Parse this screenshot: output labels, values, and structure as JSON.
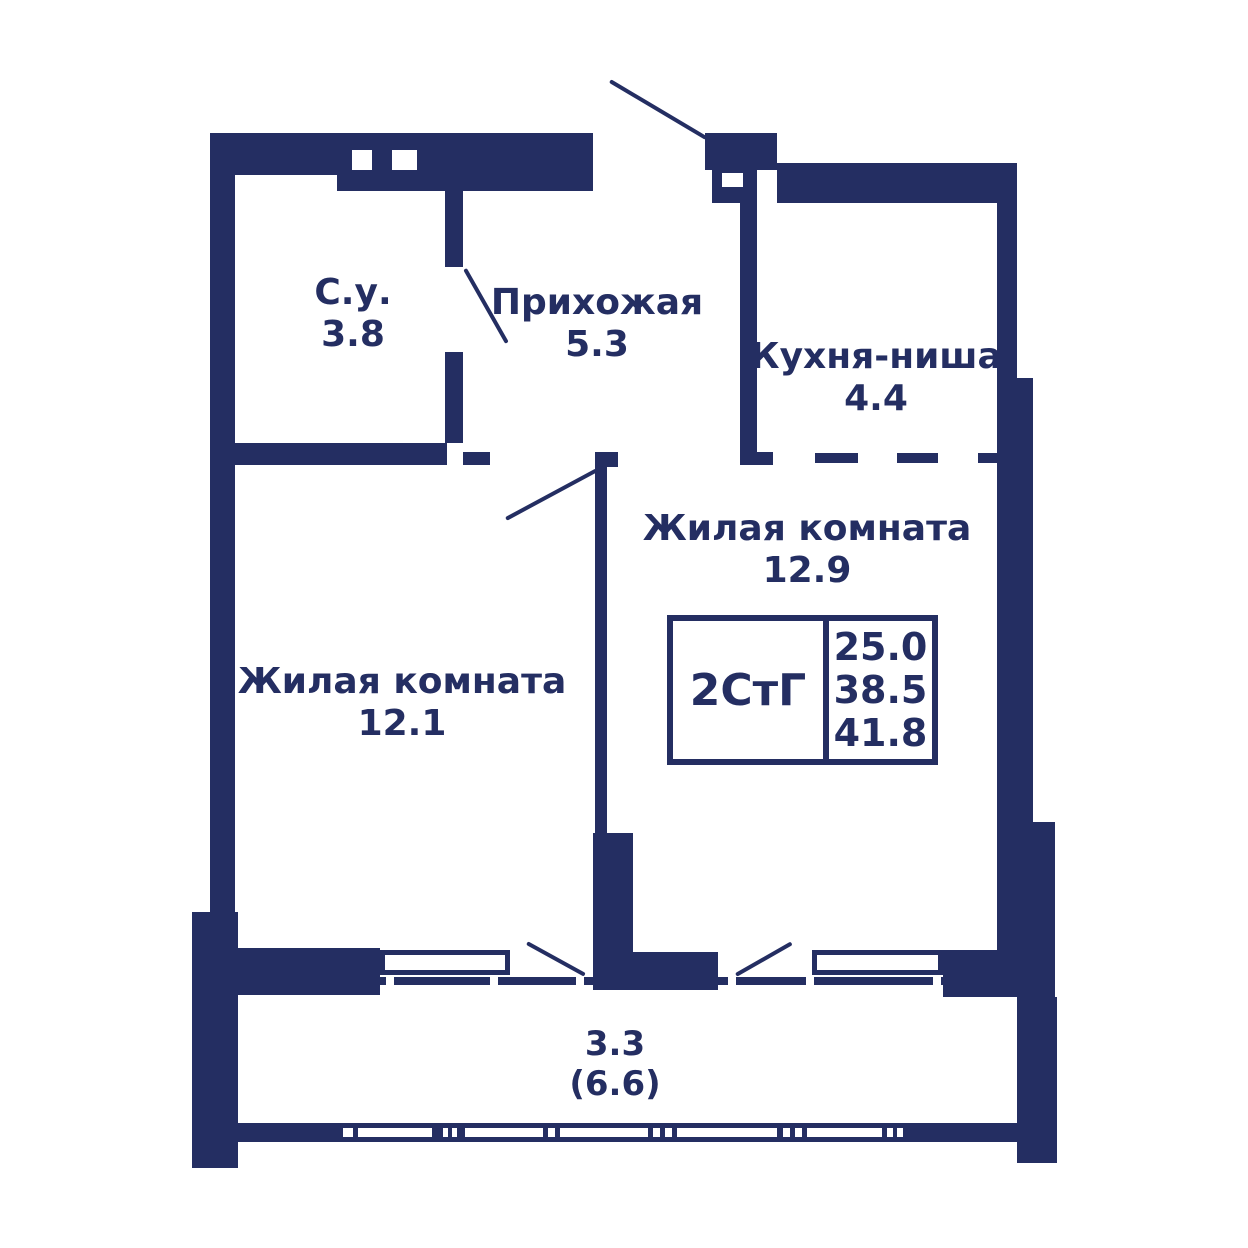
{
  "colors": {
    "wall": "#242e62",
    "bg": "#ffffff"
  },
  "unit": {
    "type_label": "2СтГ",
    "area_living": "25.0",
    "area_main": "38.5",
    "area_total": "41.8"
  },
  "rooms": {
    "bathroom": {
      "name": "С.у.",
      "area": "3.8"
    },
    "hallway": {
      "name": "Прихожая",
      "area": "5.3"
    },
    "kitchen": {
      "name": "Кухня-ниша",
      "area": "4.4"
    },
    "living1": {
      "name": "Жилая комната",
      "area": "12.9"
    },
    "living2": {
      "name": "Жилая комната",
      "area": "12.1"
    },
    "balcony": {
      "area_reduced": "3.3",
      "area_full": "(6.6)"
    }
  }
}
